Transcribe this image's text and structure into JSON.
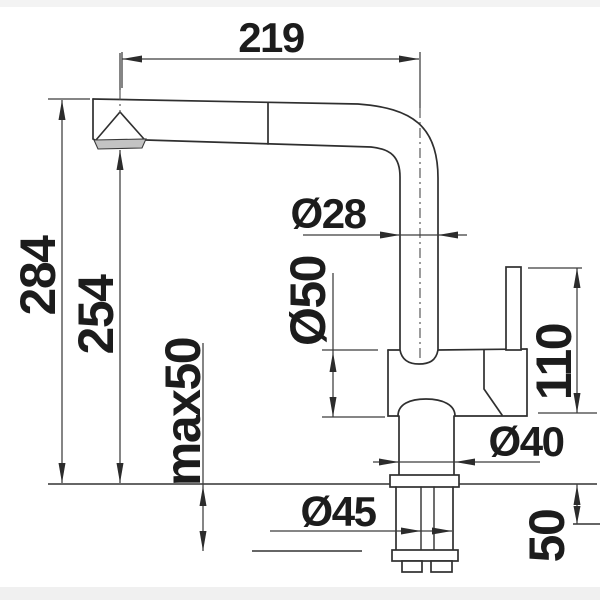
{
  "drawing": {
    "type": "faucet-installation-dimension-drawing",
    "units_implied": "mm",
    "dimensions": {
      "reach": "219",
      "total_height": "284",
      "outlet_height": "254",
      "max_counter_thickness": "max50",
      "spout_diameter": "Ø28",
      "body_diameter": "Ø50",
      "upper_height": "110",
      "neck_diameter": "Ø40",
      "base_diameter": "Ø45",
      "shank_length": "50"
    },
    "colors": {
      "outline": "#2f2f2f",
      "dimension_line": "#3c3c3c",
      "text": "#1c1c1c",
      "background": "#ffffff",
      "edge_band": "#f3f3f3",
      "aerator_fill": "#c3c3c3"
    }
  }
}
